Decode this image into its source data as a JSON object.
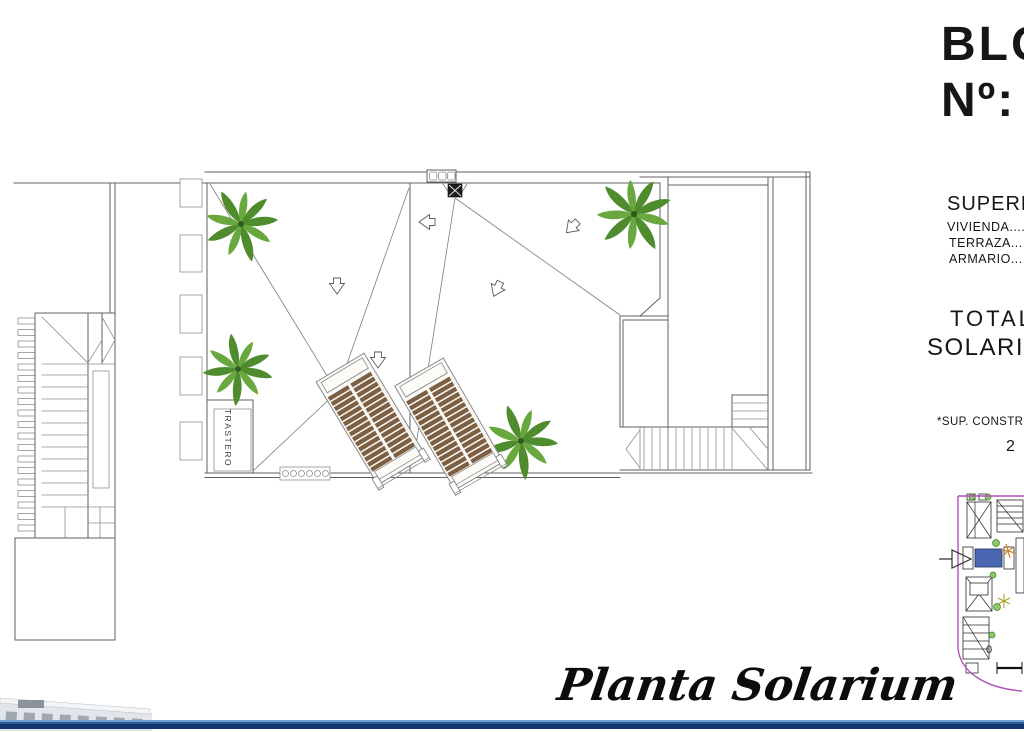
{
  "title_block": {
    "bloque": "BLOQUE",
    "numero": "Nº:",
    "superficies_header": "SUPERFICIES",
    "lines": [
      "VIVIENDA.....",
      "TERRAZA.....",
      "ARMARIO....."
    ],
    "total": "TOTAL",
    "solarium": "SOLARIUM...",
    "sup_constr": "*SUP. CONSTRUIDA",
    "value": "2"
  },
  "plan": {
    "trastero": "TRASTERO",
    "drawing_title": "Planta Solarium"
  },
  "key_plan": {
    "scale_zero": "0"
  },
  "colors": {
    "palm-a": "#4e8c2d",
    "palm-b": "#69a83e",
    "palm-dark": "#2f5c1c",
    "wood": "#7d6044",
    "hl-blue": "#4a67b2",
    "magenta": "#b44fb8",
    "band-light": "#6f9bd2",
    "band-dark": "#12356b",
    "kp-line": "#2a2a2a",
    "palm-orange": "#c8862a"
  }
}
